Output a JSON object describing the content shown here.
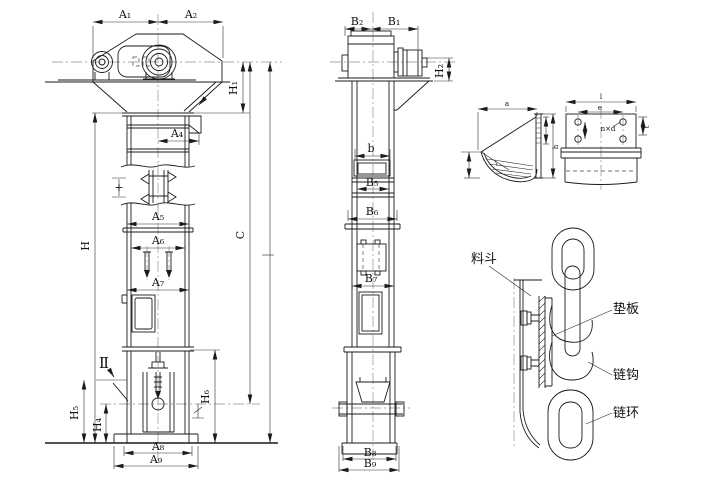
{
  "colors": {
    "line": "#1b1b1b",
    "dimension": "#2a2a2a",
    "centerline": "#8f8f8f",
    "background": "#ffffff"
  },
  "front_view": {
    "a1": "A₁",
    "a2": "A₂",
    "a4": "A₄",
    "a5": "A₅",
    "a6": "A₆",
    "a7": "A₇",
    "a8": "A₈",
    "a9": "A₉",
    "h": "H",
    "h1": "H₁",
    "h4": "H₄",
    "h5": "H₅",
    "h6": "H₆",
    "c": "C",
    "section_mark": "Ⅱ",
    "chain_pitch_mark": "+"
  },
  "side_view": {
    "b1": "B₁",
    "b2": "B₂",
    "b": "b",
    "b5": "B₅",
    "b6": "B₆",
    "b7": "B₇",
    "b8": "B₈",
    "b9": "B₉",
    "h2": "H₂"
  },
  "bucket_side_detail": {
    "width": "a",
    "height": "h"
  },
  "bucket_front_detail": {
    "width": "l",
    "hole_spacing": "e",
    "holes": "n×d",
    "edge": "t"
  },
  "chain_detail": {
    "bucket_label": "料斗",
    "pad_label": "垫板",
    "hook_label": "链钩",
    "link_label": "链环"
  }
}
